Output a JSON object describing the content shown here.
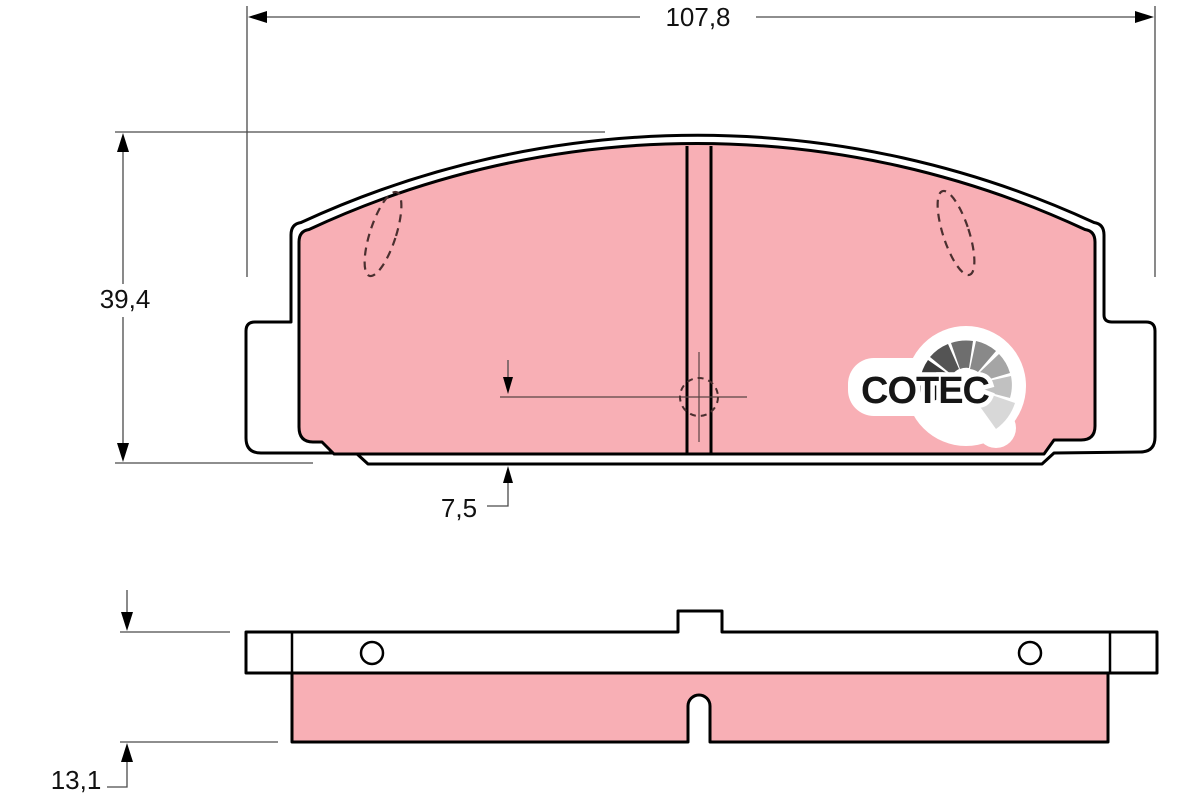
{
  "dimensions": {
    "overall_width": "107,8",
    "overall_height": "39,4",
    "wear_limit": "7,5",
    "total_thickness": "13,1"
  },
  "logo": {
    "text": "COTEC",
    "gauge_colors": [
      "#111111",
      "#3a3a3a",
      "#545454",
      "#6e6e6e",
      "#898989",
      "#a5a5a5",
      "#c1c1c1",
      "#d8d8d8"
    ]
  },
  "colors": {
    "friction": "#f8afb5",
    "plate": "#ffffff",
    "outline": "#000000",
    "dimension_line": "#4a4a4a",
    "marker": "#4a2f2f"
  }
}
